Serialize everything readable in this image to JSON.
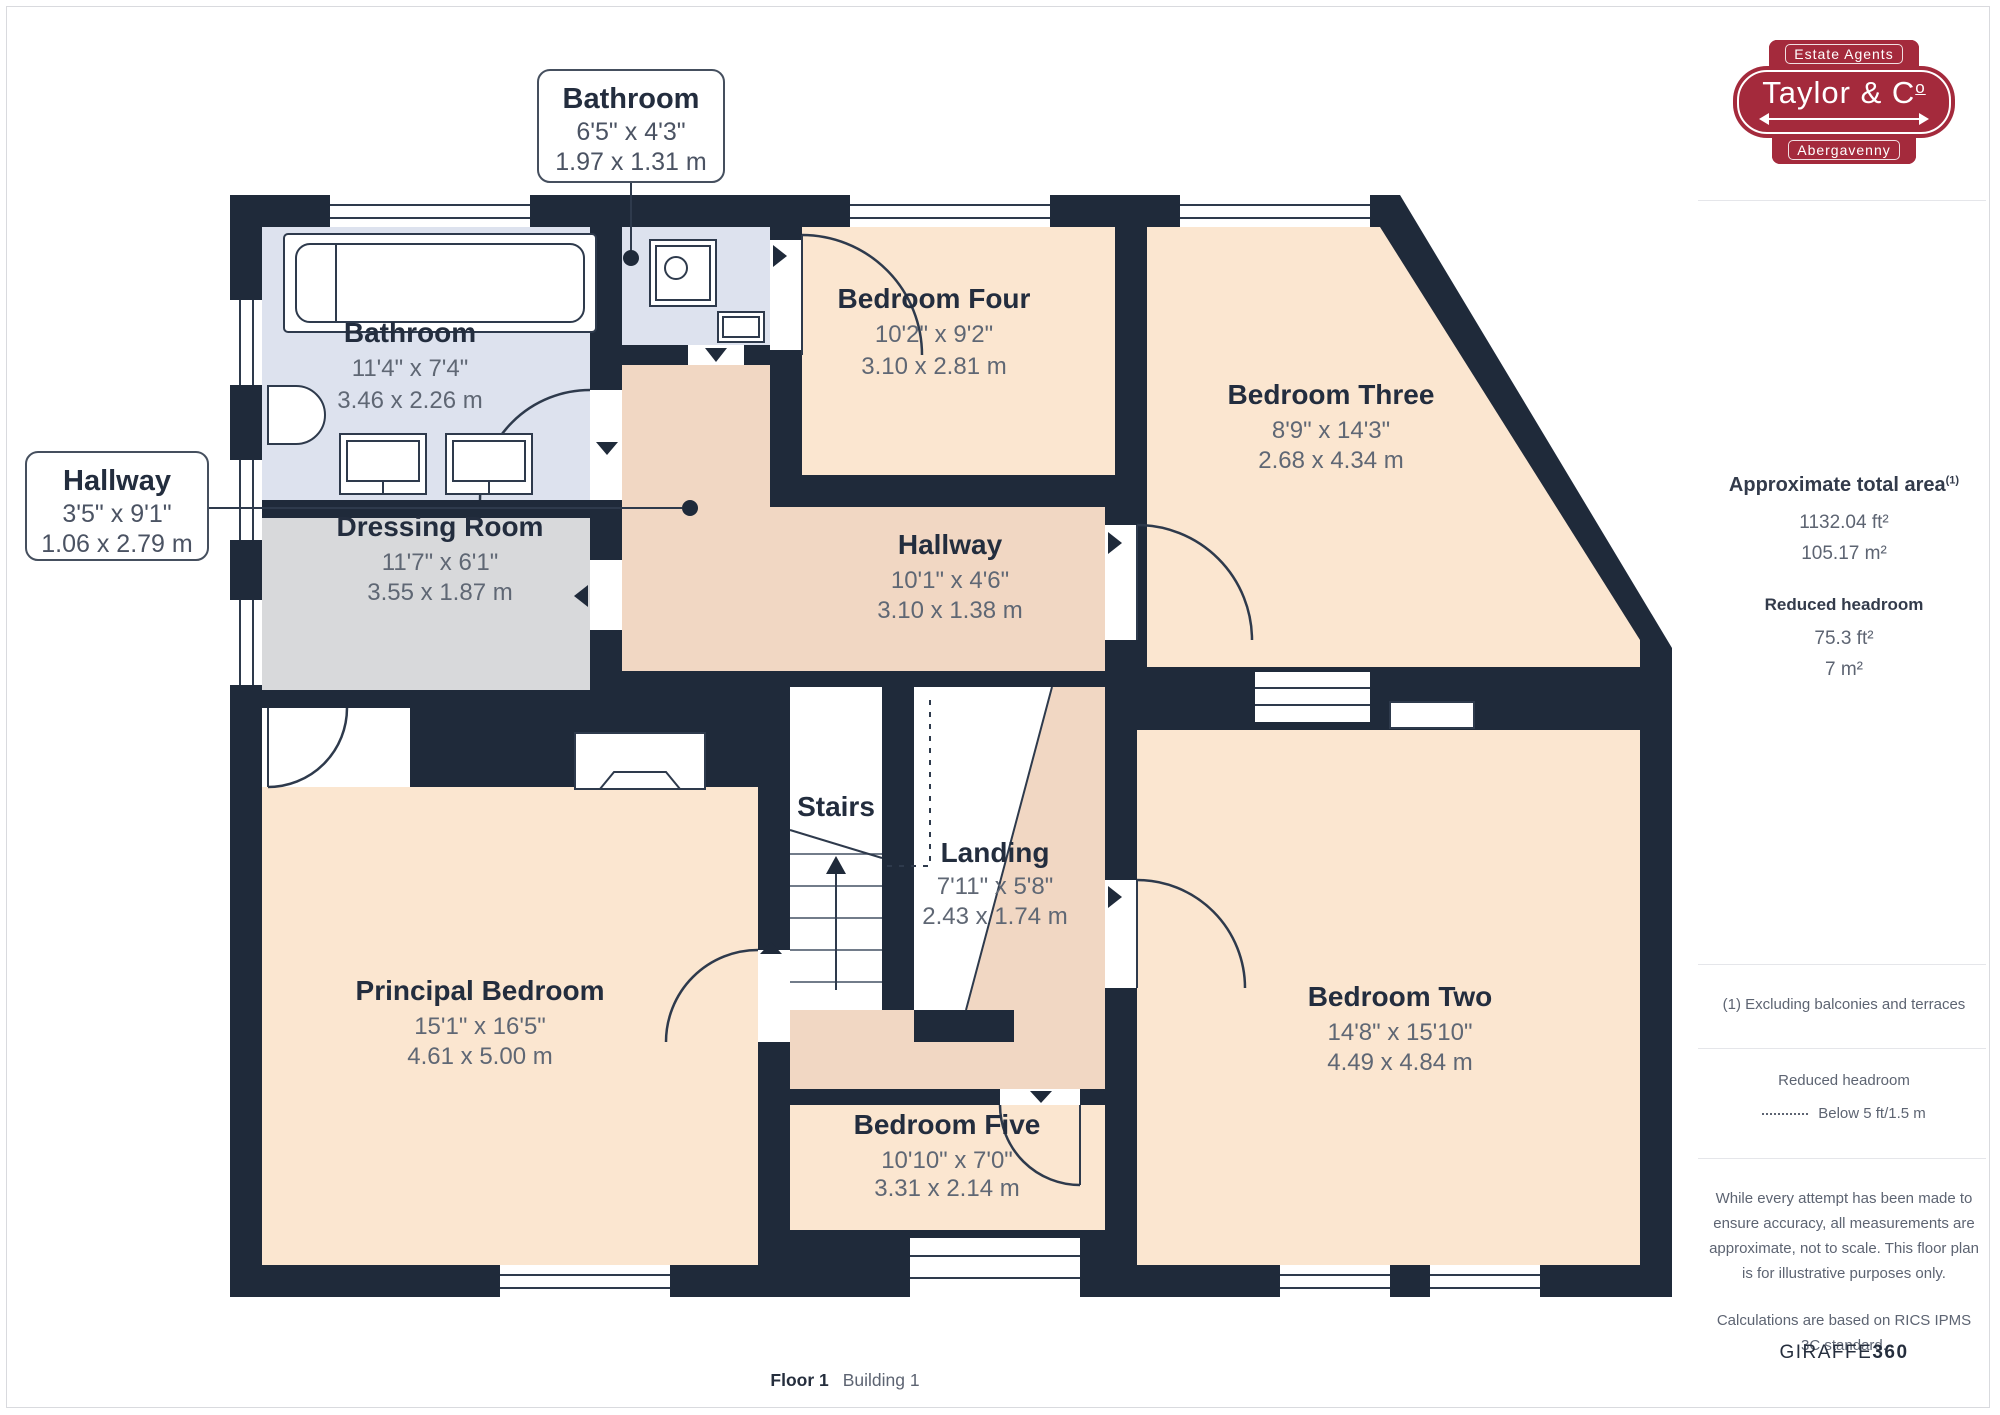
{
  "branding": {
    "tagline": "Estate Agents",
    "name_prefix": "Taylor & C",
    "name_o": "o",
    "town": "Abergavenny"
  },
  "sidebar": {
    "total_area_label": "Approximate total area",
    "total_area_sup": "(1)",
    "total_area_ft": "1132.04 ft²",
    "total_area_m": "105.17 m²",
    "reduced_label": "Reduced headroom",
    "reduced_ft": "75.3 ft²",
    "reduced_m": "7 m²",
    "footnote": "(1) Excluding balconies and terraces",
    "legend_title": "Reduced headroom",
    "legend_item": "Below 5 ft/1.5 m",
    "disclaimer": "While every attempt has been made to ensure accuracy, all measurements are approximate, not to scale. This floor plan is for illustrative purposes only.",
    "standard": "Calculations are based on RICS IPMS 3C standard.",
    "brand_giraffe": "GIRAFFE",
    "brand_360": "360"
  },
  "callouts": {
    "bathroom": {
      "name": "Bathroom",
      "ft": "6'5\" x 4'3\"",
      "m": "1.97 x 1.31 m"
    },
    "hallway": {
      "name": "Hallway",
      "ft": "3'5\" x 9'1\"",
      "m": "1.06 x 2.79 m"
    }
  },
  "rooms": {
    "bathroom": {
      "name": "Bathroom",
      "ft": "11'4\" x 7'4\"",
      "m": "3.46 x 2.26 m"
    },
    "bedroom4": {
      "name": "Bedroom Four",
      "ft": "10'2\" x 9'2\"",
      "m": "3.10 x 2.81 m"
    },
    "bedroom3": {
      "name": "Bedroom Three",
      "ft": "8'9\" x 14'3\"",
      "m": "2.68 x 4.34 m"
    },
    "dressing": {
      "name": "Dressing Room",
      "ft": "11'7\" x 6'1\"",
      "m": "3.55 x 1.87 m"
    },
    "hallway": {
      "name": "Hallway",
      "ft": "10'1\" x 4'6\"",
      "m": "3.10 x 1.38 m"
    },
    "landing": {
      "name": "Landing",
      "ft": "7'11\" x 5'8\"",
      "m": "2.43 x 1.74 m"
    },
    "stairs": {
      "name": "Stairs"
    },
    "principal": {
      "name": "Principal Bedroom",
      "ft": "15'1\" x 16'5\"",
      "m": "4.61 x 5.00 m"
    },
    "bedroom2": {
      "name": "Bedroom Two",
      "ft": "14'8\" x 15'10\"",
      "m": "4.49 x 4.84 m"
    },
    "bedroom5": {
      "name": "Bedroom Five",
      "ft": "10'10\" x 7'0\"",
      "m": "3.31 x 2.14 m"
    }
  },
  "footer": {
    "floor": "Floor 1",
    "building": "Building 1"
  },
  "colors": {
    "brand_red": "#a42a3c",
    "wall": "#1f2a3a",
    "room_peach": "#fbe6d0",
    "room_salmon": "#f1d7c3",
    "room_blue": "#dde2ee",
    "room_gray": "#d8d9db"
  }
}
